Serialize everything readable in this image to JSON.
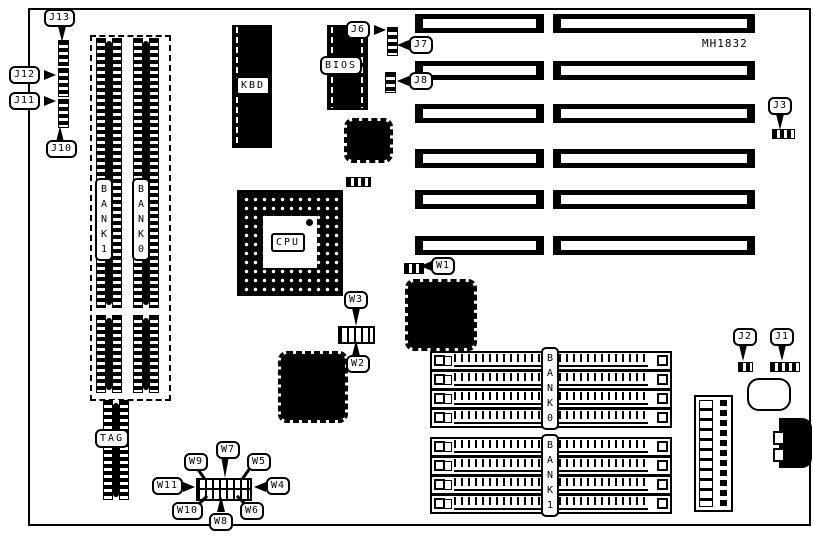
{
  "board": {
    "model": "MH1832"
  },
  "chips": {
    "kbd": "KBD",
    "bios": "BIOS",
    "cpu": "CPU",
    "tag": "TAG"
  },
  "memory": {
    "left_bank1": "BANK1",
    "left_bank0": "BANK0",
    "right_bank0": "BANK0",
    "right_bank1": "BANK1"
  },
  "jumpers": {
    "j1": "J1",
    "j2": "J2",
    "j3": "J3",
    "j6": "J6",
    "j7": "J7",
    "j8": "J8",
    "j10": "J10",
    "j11": "J11",
    "j12": "J12",
    "j13": "J13",
    "w1": "W1",
    "w2": "W2",
    "w3": "W3",
    "w4": "W4",
    "w5": "W5",
    "w6": "W6",
    "w7": "W7",
    "w8": "W8",
    "w9": "W9",
    "w10": "W10",
    "w11": "W11"
  }
}
